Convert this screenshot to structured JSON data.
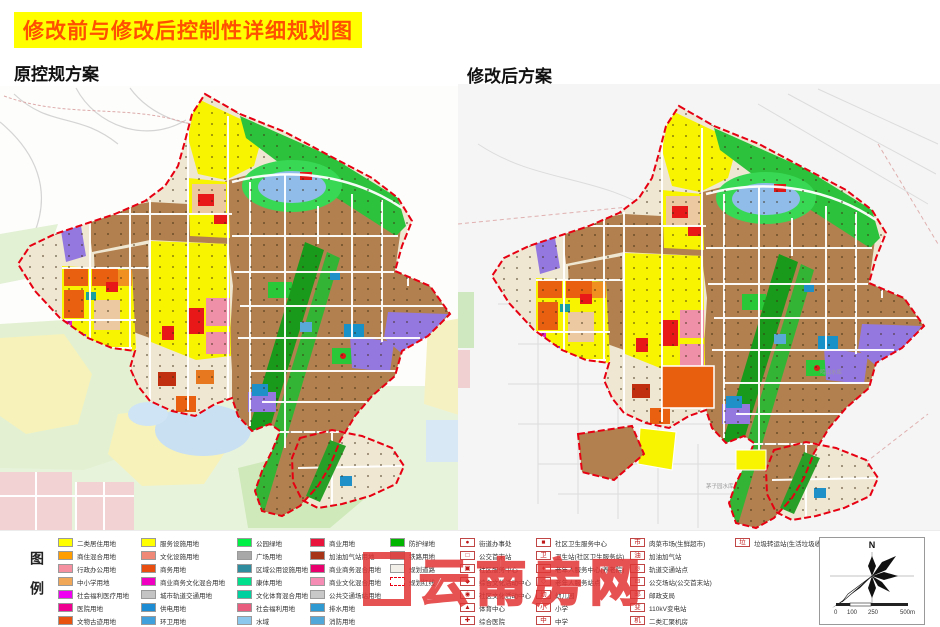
{
  "title": "修改前与修改后控制性详细规划图",
  "left_map": {
    "heading": "原控规方案"
  },
  "right_map": {
    "heading": "修改后方案",
    "water_labels": [
      "鸣山水库",
      "茅子园水库"
    ]
  },
  "watermark": "云南房网",
  "legend": {
    "label": "图例",
    "columns": [
      {
        "type": "color",
        "items": [
          {
            "color": "#ffff00",
            "label": "二类居住用地"
          },
          {
            "color": "#ff9e00",
            "label": "商住混合用地"
          },
          {
            "color": "#f590a0",
            "label": "行政办公用地"
          },
          {
            "color": "#f0a858",
            "label": "中小学用地"
          },
          {
            "color": "#f000f0",
            "label": "社会福利医疗用地"
          },
          {
            "color": "#f00090",
            "label": "医院用地"
          },
          {
            "color": "#e85410",
            "label": "文物古迹用地"
          }
        ]
      },
      {
        "type": "color",
        "items": [
          {
            "color": "#ffff00",
            "label": "服务设施用地"
          },
          {
            "color": "#f08878",
            "label": "文化设施用地"
          },
          {
            "color": "#e84e10",
            "label": "商务用地"
          },
          {
            "color": "#f000c0",
            "label": "商业商务文化混合用地"
          },
          {
            "color": "#c4c4c4",
            "label": "城市轨道交通用地"
          },
          {
            "color": "#1e8cd2",
            "label": "供电用地"
          },
          {
            "color": "#3fa0dc",
            "label": "环卫用地"
          }
        ]
      },
      {
        "type": "color",
        "items": [
          {
            "color": "#00f046",
            "label": "公园绿地"
          },
          {
            "color": "#a8a8a8",
            "label": "广场用地"
          },
          {
            "color": "#2e8c9e",
            "label": "区域公用设施用地"
          },
          {
            "color": "#00e08c",
            "label": "康体用地"
          },
          {
            "color": "#00cfa0",
            "label": "文化体育混合用地"
          },
          {
            "color": "#e85c7e",
            "label": "社会福利用地"
          },
          {
            "color": "#8cc8ee",
            "label": "水域"
          }
        ]
      },
      {
        "type": "color",
        "items": [
          {
            "color": "#e8143c",
            "label": "商业用地"
          },
          {
            "color": "#a83418",
            "label": "加油加气站用地"
          },
          {
            "color": "#e8006e",
            "label": "商业商务混合用地"
          },
          {
            "color": "#f48cb4",
            "label": "商业文化混合用地"
          },
          {
            "color": "#c8c8c8",
            "label": "公共交通场站用地"
          },
          {
            "color": "#2f9ad2",
            "label": "排水用地"
          },
          {
            "color": "#52a8d8",
            "label": "消防用地"
          }
        ]
      },
      {
        "type": "color",
        "items": [
          {
            "color": "#00b400",
            "label": "防护绿地"
          },
          {
            "color": "#b4b4b4",
            "label": "铁路用地"
          },
          {
            "color": "#f2efe8",
            "label": "规划道路",
            "road": true
          },
          {
            "color": "#ffffff",
            "label": "规划红线",
            "dashed": true
          }
        ]
      },
      {
        "type": "symbol",
        "items": [
          {
            "glyph": "●",
            "label": "街道办事处"
          },
          {
            "glyph": "□",
            "label": "公交首末站"
          },
          {
            "glyph": "▣",
            "label": "社区服务中心"
          },
          {
            "glyph": "◆",
            "label": "综合文化活动中心"
          },
          {
            "glyph": "◉",
            "label": "社区文化活动中心"
          },
          {
            "glyph": "▲",
            "label": "体育中心"
          },
          {
            "glyph": "✚",
            "label": "综合医院"
          }
        ]
      },
      {
        "type": "symbol",
        "items": [
          {
            "glyph": "■",
            "label": "社区卫生服务中心"
          },
          {
            "glyph": "卫",
            "label": "卫生站(社区卫生服务站)"
          },
          {
            "glyph": "♦",
            "label": "老年人服务中心(养老院)"
          },
          {
            "glyph": "◇",
            "label": "老年人服务站点"
          },
          {
            "glyph": "幼",
            "label": "幼儿园"
          },
          {
            "glyph": "小",
            "label": "小学"
          },
          {
            "glyph": "中",
            "label": "中学"
          }
        ]
      },
      {
        "type": "symbol",
        "items": [
          {
            "glyph": "市",
            "label": "肉菜市场(生鲜超市)"
          },
          {
            "glyph": "油",
            "label": "加油加气站"
          },
          {
            "glyph": "◎",
            "label": "轨道交通站点"
          },
          {
            "glyph": "⊟",
            "label": "公交场站(公交首末站)"
          },
          {
            "glyph": "邮",
            "label": "邮政支局"
          },
          {
            "glyph": "变",
            "label": "110kV变电站"
          },
          {
            "glyph": "机",
            "label": "二类汇聚机房"
          }
        ]
      },
      {
        "type": "symbol",
        "items": [
          {
            "glyph": "垃",
            "label": "垃圾转运站(生活垃圾收集站)"
          }
        ]
      }
    ]
  },
  "compass": {
    "north": "N",
    "scale_ticks": [
      "0",
      "100",
      "250",
      "500m"
    ]
  },
  "accent_colors": {
    "boundary_red": "#e60012",
    "residential_brown": "#b2804e",
    "title_bg": "#ffff00",
    "title_text": "#ff4f00"
  }
}
